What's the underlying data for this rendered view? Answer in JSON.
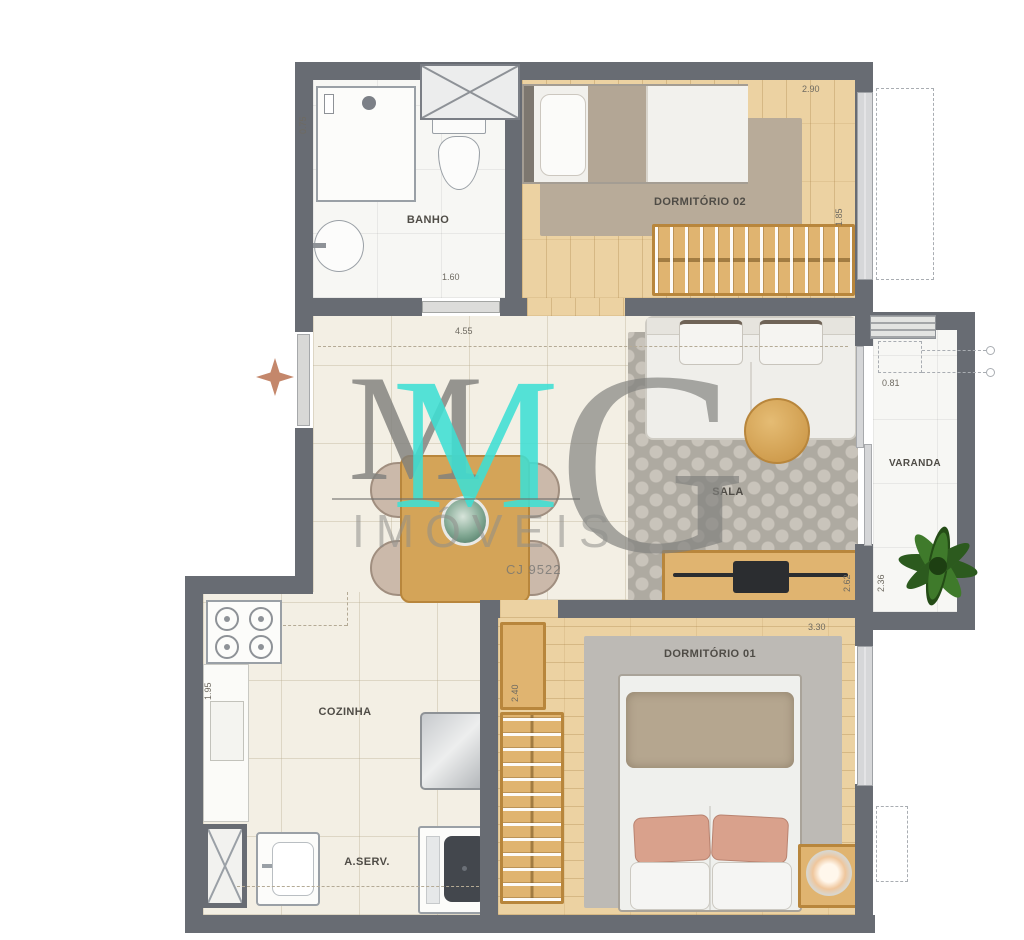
{
  "plan": {
    "rooms": {
      "banho": "BANHO",
      "dormitorio2": "DORMITÓRIO 02",
      "sala": "SALA",
      "varanda": "VARANDA",
      "cozinha": "COZINHA",
      "area_servico": "A.SERV.",
      "dormitorio1": "DORMITÓRIO 01"
    },
    "dimensions": {
      "banho_width": "1.60",
      "banho_depth": "0.75",
      "dormitorio2_width": "2.90",
      "dormitorio2_depth": "1.85",
      "living_width": "4.55",
      "varanda_width": "0.81",
      "varanda_depth": "2.36",
      "sala_depth": "2.62",
      "dormitorio1_width": "3.30",
      "dormitorio1_depth": "2.40",
      "cozinha_depth": "1.95"
    }
  },
  "watermark": {
    "initial_m": "M",
    "initial_g": "G",
    "brand": "IMÓVEIS",
    "license": "CJ 9522"
  },
  "colors": {
    "wall": "#686c73",
    "wood_floor": "#ecd2a2",
    "tile_floor": "#f3efe4",
    "accent_teal": "#3edfd4",
    "furniture_wood": "#d9a85c",
    "plant_green": "#2f641f",
    "entry_arrow": "#c4876b"
  }
}
